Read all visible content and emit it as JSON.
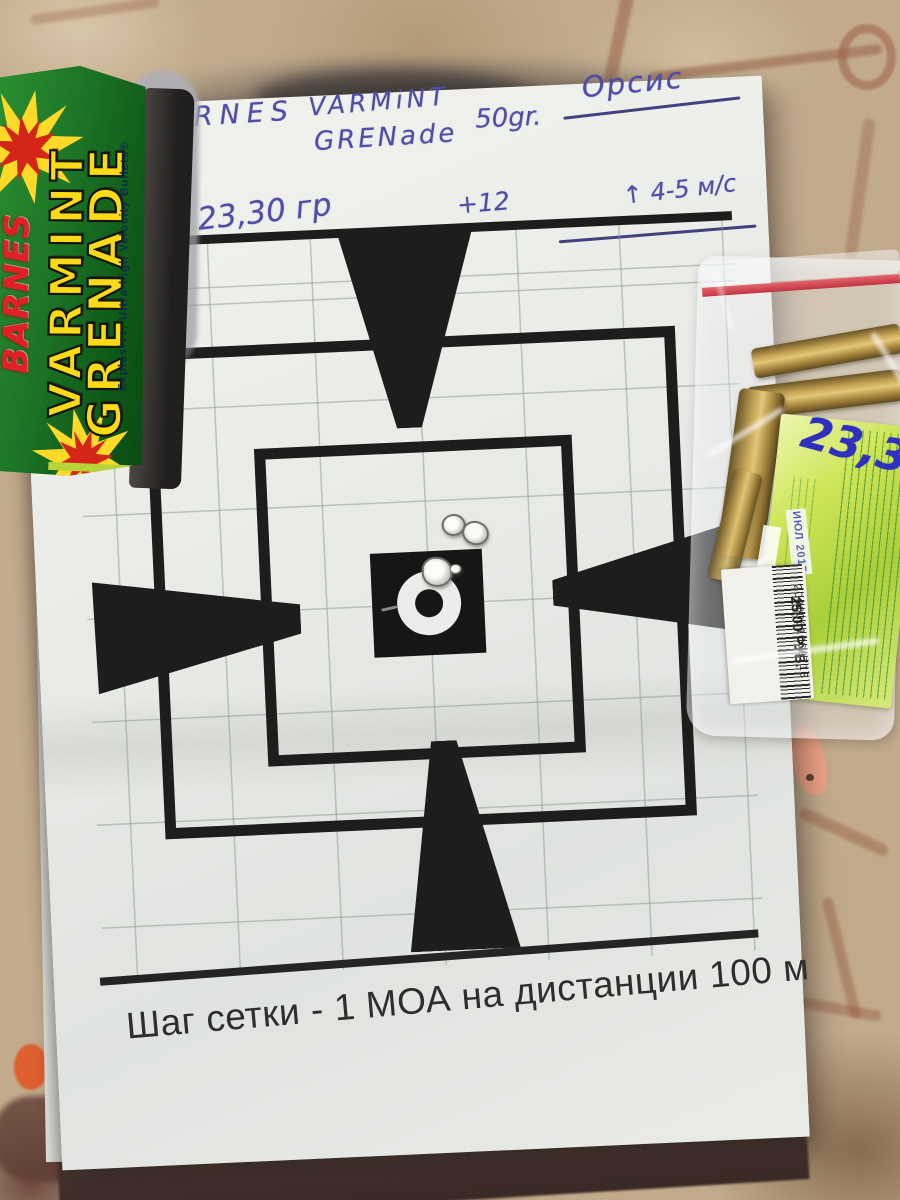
{
  "scene": {
    "description": "photo of a paper sight-in target on a tiled floor with an ammo box and a zip bag of brass cases",
    "colors": {
      "floor_tan": "#c2ab8d",
      "grout_brown": "#8f4f38",
      "target_black": "#1d1d1d",
      "handwriting_ink": "#4f4da5",
      "box_green": "#1d7526",
      "box_yellow": "#f8da16",
      "brand_red": "#e31f25",
      "label_green": "#b8d83a",
      "zipper_red": "#d84a52",
      "brass": "#c6a355"
    }
  },
  "target_sheet": {
    "handwriting": {
      "brand": "BARNES",
      "model_line1": "VARMiNT",
      "model_line2": "GRENade",
      "bullet_weight": "50gr.",
      "rifle_name": "Орсис",
      "powder_charge": "23,30 гр",
      "correction": "+12",
      "wind": "↑ 4-5 м/с"
    },
    "caption": "Шаг сетки - 1 МОА на дистанции 100 м"
  },
  "ammo_box": {
    "brand": "BARNES",
    "product_line1": "VARMINT",
    "product_line2": "GRENADE",
    "tagline": "Explosive, Ultra-high Velocity Bullets®"
  },
  "cartridge_bag": {
    "handwritten_weight": "23,30",
    "date_stamp": "ИЮЛ 2017",
    "price": "25,00 РУБ.",
    "barcode_number": "2000061062713"
  }
}
